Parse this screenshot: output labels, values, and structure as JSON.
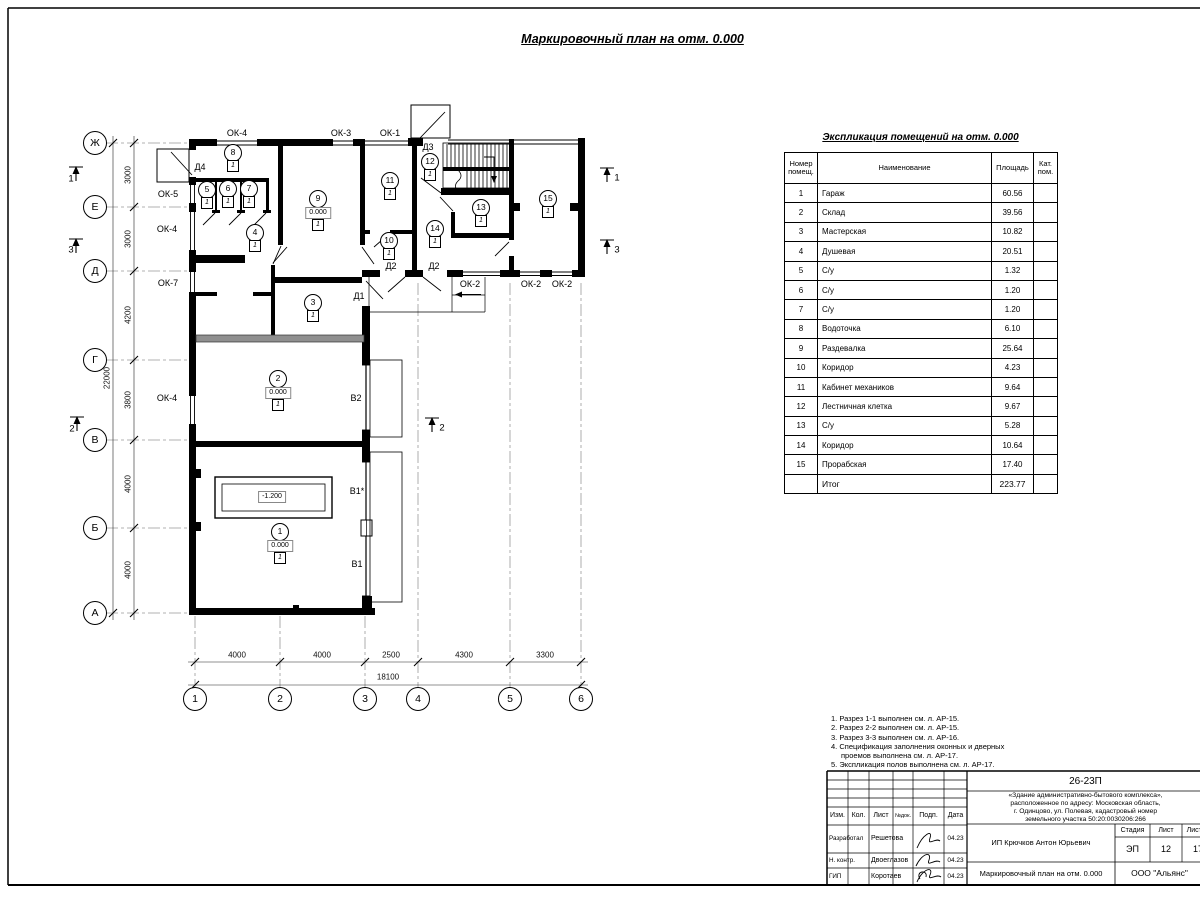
{
  "plan_title": "Маркировочный план на отм. 0.000",
  "table": {
    "title": "Экспликация помещений на отм. 0.000",
    "col_headers": {
      "num": "Номер помещ.",
      "name": "Наименование",
      "area": "Площадь",
      "cat": "Кат. пом."
    },
    "rows": [
      {
        "num": "1",
        "name": "Гараж",
        "area": "60.56"
      },
      {
        "num": "2",
        "name": "Склад",
        "area": "39.56"
      },
      {
        "num": "3",
        "name": "Мастерская",
        "area": "10.82"
      },
      {
        "num": "4",
        "name": "Душевая",
        "area": "20.51"
      },
      {
        "num": "5",
        "name": "С/у",
        "area": "1.32"
      },
      {
        "num": "6",
        "name": "С/у",
        "area": "1.20"
      },
      {
        "num": "7",
        "name": "С/у",
        "area": "1.20"
      },
      {
        "num": "8",
        "name": "Водоточка",
        "area": "6.10"
      },
      {
        "num": "9",
        "name": "Раздевалка",
        "area": "25.64"
      },
      {
        "num": "10",
        "name": "Коридор",
        "area": "4.23"
      },
      {
        "num": "11",
        "name": "Кабинет механиков",
        "area": "9.64"
      },
      {
        "num": "12",
        "name": "Лестничная клетка",
        "area": "9.67"
      },
      {
        "num": "13",
        "name": "С/у",
        "area": "5.28"
      },
      {
        "num": "14",
        "name": "Коридор",
        "area": "10.64"
      },
      {
        "num": "15",
        "name": "Прорабская",
        "area": "17.40"
      }
    ],
    "total": {
      "label": "Итог",
      "value": "223.77"
    }
  },
  "notes": [
    {
      "text": "1. Разрез 1-1 выполнен см. л. АР-15.",
      "indent": false
    },
    {
      "text": "2. Разрез 2-2 выполнен см. л. АР-15.",
      "indent": false
    },
    {
      "text": "3. Разрез 3-3 выполнен см. л. АР-16.",
      "indent": false
    },
    {
      "text": "4. Спецификация заполнения оконных и дверных",
      "indent": false
    },
    {
      "text": "проемов выполнена см. л. АР-17.",
      "indent": true
    },
    {
      "text": "5. Экспликация полов выполнена см. л. АР-17.",
      "indent": false
    }
  ],
  "plan": {
    "axes_left": [
      {
        "label": "Ж",
        "y": 143
      },
      {
        "label": "Е",
        "y": 207
      },
      {
        "label": "Д",
        "y": 271
      },
      {
        "label": "Г",
        "y": 360
      },
      {
        "label": "В",
        "y": 440
      },
      {
        "label": "Б",
        "y": 528
      },
      {
        "label": "А",
        "y": 613
      }
    ],
    "axes_bottom": [
      {
        "label": "1",
        "x": 195
      },
      {
        "label": "2",
        "x": 280
      },
      {
        "label": "3",
        "x": 365
      },
      {
        "label": "4",
        "x": 418
      },
      {
        "label": "5",
        "x": 510
      },
      {
        "label": "6",
        "x": 581
      }
    ],
    "dims_left": [
      {
        "text": "3000",
        "y": 175
      },
      {
        "text": "3000",
        "y": 239
      },
      {
        "text": "4200",
        "y": 315
      },
      {
        "text": "3800",
        "y": 400
      },
      {
        "text": "4000",
        "y": 484
      },
      {
        "text": "4000",
        "y": 570
      }
    ],
    "dim_left_total": {
      "text": "22000",
      "x": 107,
      "y": 378
    },
    "dims_bottom": [
      {
        "text": "4000",
        "x": 237
      },
      {
        "text": "4000",
        "x": 322
      },
      {
        "text": "2500",
        "x": 391
      },
      {
        "text": "4300",
        "x": 464
      },
      {
        "text": "3300",
        "x": 545
      }
    ],
    "dim_bottom_total": {
      "text": "18100",
      "x": 388,
      "y": 677
    },
    "opening_labels": [
      {
        "text": "ОК-4",
        "x": 237,
        "y": 133
      },
      {
        "text": "ОК-3",
        "x": 341,
        "y": 133
      },
      {
        "text": "ОК-1",
        "x": 390,
        "y": 133
      },
      {
        "text": "ОК-5",
        "x": 168,
        "y": 194
      },
      {
        "text": "ОК-4",
        "x": 167,
        "y": 229
      },
      {
        "text": "ОК-7",
        "x": 168,
        "y": 283
      },
      {
        "text": "ОК-4",
        "x": 167,
        "y": 398
      },
      {
        "text": "ОК-2",
        "x": 470,
        "y": 284
      },
      {
        "text": "ОК-2",
        "x": 531,
        "y": 284
      },
      {
        "text": "ОК-2",
        "x": 562,
        "y": 284
      },
      {
        "text": "Д4",
        "x": 200,
        "y": 167
      },
      {
        "text": "Д3",
        "x": 428,
        "y": 147
      },
      {
        "text": "Д2",
        "x": 391,
        "y": 266
      },
      {
        "text": "Д2",
        "x": 434,
        "y": 266
      },
      {
        "text": "Д1",
        "x": 359,
        "y": 296
      },
      {
        "text": "В2",
        "x": 356,
        "y": 398
      },
      {
        "text": "В1*",
        "x": 357,
        "y": 491
      },
      {
        "text": "В1",
        "x": 357,
        "y": 564
      }
    ],
    "rooms": [
      {
        "num": "1",
        "x": 280,
        "y": 532,
        "elev": "0.000",
        "cat": "1"
      },
      {
        "num": "2",
        "x": 278,
        "y": 379,
        "elev": "0.000",
        "cat": "1"
      },
      {
        "num": "3",
        "x": 313,
        "y": 303,
        "cat": "1"
      },
      {
        "num": "4",
        "x": 255,
        "y": 233,
        "cat": "1"
      },
      {
        "num": "5",
        "x": 207,
        "y": 190,
        "cat": "1"
      },
      {
        "num": "6",
        "x": 228,
        "y": 189,
        "cat": "1"
      },
      {
        "num": "7",
        "x": 249,
        "y": 189,
        "cat": "1"
      },
      {
        "num": "8",
        "x": 233,
        "y": 153,
        "cat": "1"
      },
      {
        "num": "9",
        "x": 318,
        "y": 199,
        "elev": "0.000",
        "cat": "1"
      },
      {
        "num": "10",
        "x": 389,
        "y": 241,
        "cat": "1"
      },
      {
        "num": "11",
        "x": 390,
        "y": 181,
        "cat": "1"
      },
      {
        "num": "12",
        "x": 430,
        "y": 162,
        "cat": "1"
      },
      {
        "num": "13",
        "x": 481,
        "y": 208,
        "cat": "1"
      },
      {
        "num": "14",
        "x": 435,
        "y": 229,
        "cat": "1"
      },
      {
        "num": "15",
        "x": 548,
        "y": 199,
        "cat": "1"
      }
    ],
    "pit_label": {
      "text": "-1.200",
      "x": 272,
      "y": 497
    },
    "section_marks": [
      {
        "num": "1",
        "x": 71,
        "y": 179
      },
      {
        "num": "3",
        "x": 71,
        "y": 250
      },
      {
        "num": "2",
        "x": 72,
        "y": 429
      },
      {
        "num": "1",
        "x": 617,
        "y": 178
      },
      {
        "num": "3",
        "x": 617,
        "y": 250
      },
      {
        "num": "2",
        "x": 442,
        "y": 428
      }
    ]
  },
  "titleblock": {
    "doc_code": "26-23П",
    "object_lines": [
      "«Здание административно-бытового комплекса»,",
      "расположенное по адресу: Московская область,",
      "г. Одинцово, ул. Полевая, кадастровый номер",
      "земельного участка 50:20:0030206:266"
    ],
    "cols": {
      "izm": "Изм.",
      "kol": "Кол.",
      "list": "Лист",
      "ndok": "№док.",
      "podp": "Подп.",
      "data": "Дата"
    },
    "people": [
      {
        "role": "Разработал",
        "name": "Решетова",
        "date": "04.23"
      },
      {
        "role": "Н. контр.",
        "name": "Двоеглазов",
        "date": "04.23"
      },
      {
        "role": "ГИП",
        "name": "Коротаев",
        "date": "04.23"
      }
    ],
    "client": "ИП Крючков Антон Юрьевич",
    "stage_label": "Стадия",
    "sheet_label": "Лист",
    "sheets_label": "Листов",
    "stage": "ЭП",
    "sheet": "12",
    "sheets": "17",
    "drawing_name": "Маркировочный план на отм. 0.000",
    "company": "ООО \"Альянс\""
  }
}
